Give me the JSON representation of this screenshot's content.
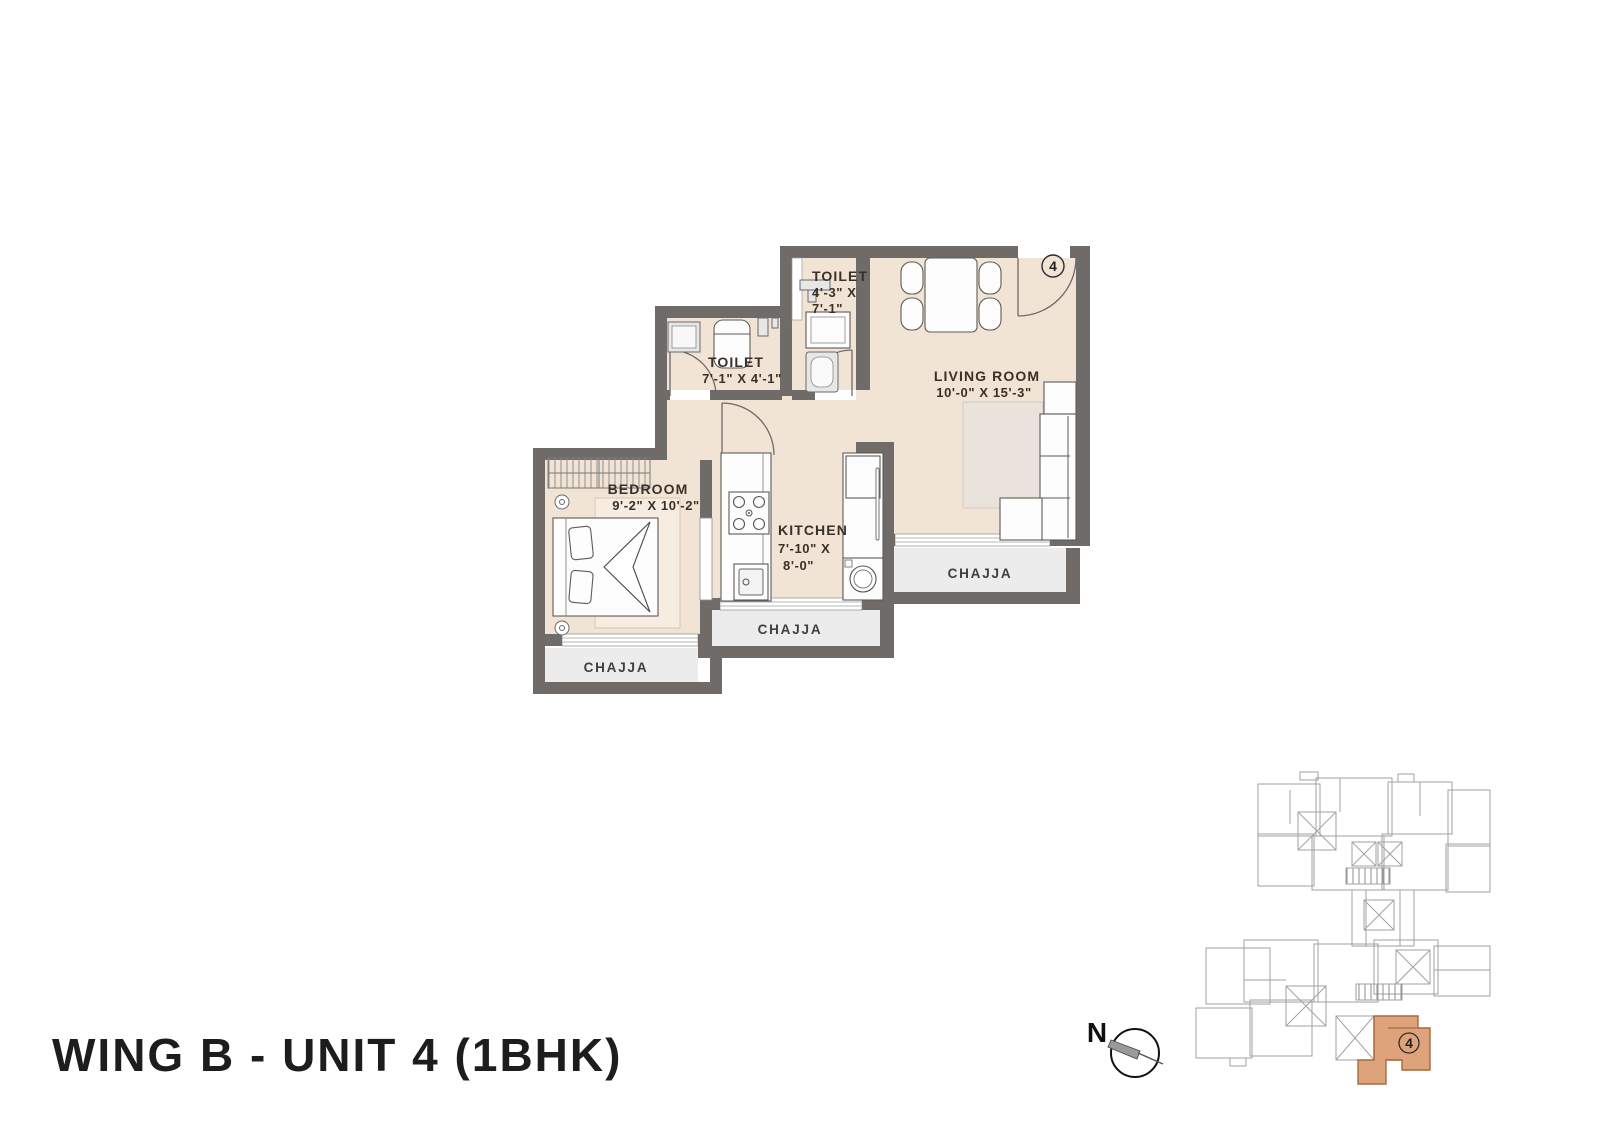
{
  "title": "WING B - UNIT 4 (1BHK)",
  "north_label": "N",
  "unit_badge": "4",
  "plan": {
    "living": {
      "name": "LIVING ROOM",
      "dims": "10'-0\" X 15'-3\""
    },
    "bedroom": {
      "name": "BEDROOM",
      "dims": "9'-2\" X 10'-2\""
    },
    "kitchen": {
      "name": "KITCHEN",
      "dims_line1": "7'-10\" X",
      "dims_line2": "8'-0\""
    },
    "toilet_top": {
      "name": "TOILET",
      "dims_line1": "4'-3\" X",
      "dims_line2": "7'-1\""
    },
    "toilet_left": {
      "name": "TOILET",
      "dims": "7'-1\" X 4'-1\""
    },
    "chajja_right": "CHAJJA",
    "chajja_middle": "CHAJJA",
    "chajja_left": "CHAJJA"
  },
  "keyplan": {
    "unit_badge": "4"
  },
  "colors": {
    "floor": "#f2e4d5",
    "wall": "#6f6b68",
    "chajja": "#ececec",
    "keyplan_highlight": "#dfa37b",
    "keyplan_highlight_stroke": "#a8693c"
  }
}
